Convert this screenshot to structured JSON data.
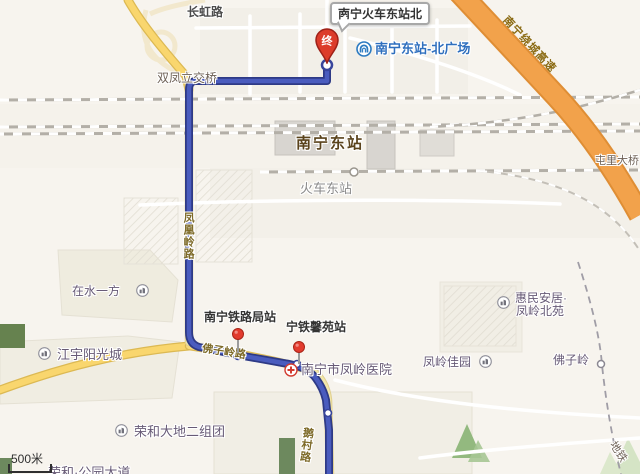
{
  "colors": {
    "route_blue": "#4a5cbe",
    "route_border": "#2e3a86",
    "highway_orange": "#f2a24b",
    "road_yellow": "#f9d66e",
    "map_background": "#f7f4ee"
  },
  "scale_bar": {
    "label": "500米"
  },
  "route": {
    "end_marker": "终",
    "destination_callout": "南宁火车东站北"
  },
  "road_labels": {
    "changhong": "长虹路",
    "shuangfeng_interchange": "双凤立交桥",
    "fenghuangling": "凤凰岭路",
    "foziling_road": "佛子岭路",
    "ecun": "鹅村路",
    "ring_expressway": "南宁绕城高速",
    "tunli_bridge": "屯里大桥",
    "metro_line": "地铁"
  },
  "stations": {
    "railway_station": "南宁东站",
    "railway_station_sub": "火车东站",
    "metro_north_plaza": "南宁东站-北广场",
    "metro_foziling": "佛子岭"
  },
  "bus_stops": {
    "tieluju": "南宁铁路局站",
    "ningtie_xinyuan": "宁铁馨苑站"
  },
  "pois": {
    "zaishuiyifang": "在水一方",
    "jiangyu": "江宇阳光城",
    "hospital": "南宁市凤岭医院",
    "huimin_line1": "惠民安居·",
    "huimin_line2": "凤岭北苑",
    "fengling_jiayuan": "凤岭佳园",
    "ronghe": "荣和大地二组团",
    "ronghe_south": "荣和·公园大道"
  }
}
